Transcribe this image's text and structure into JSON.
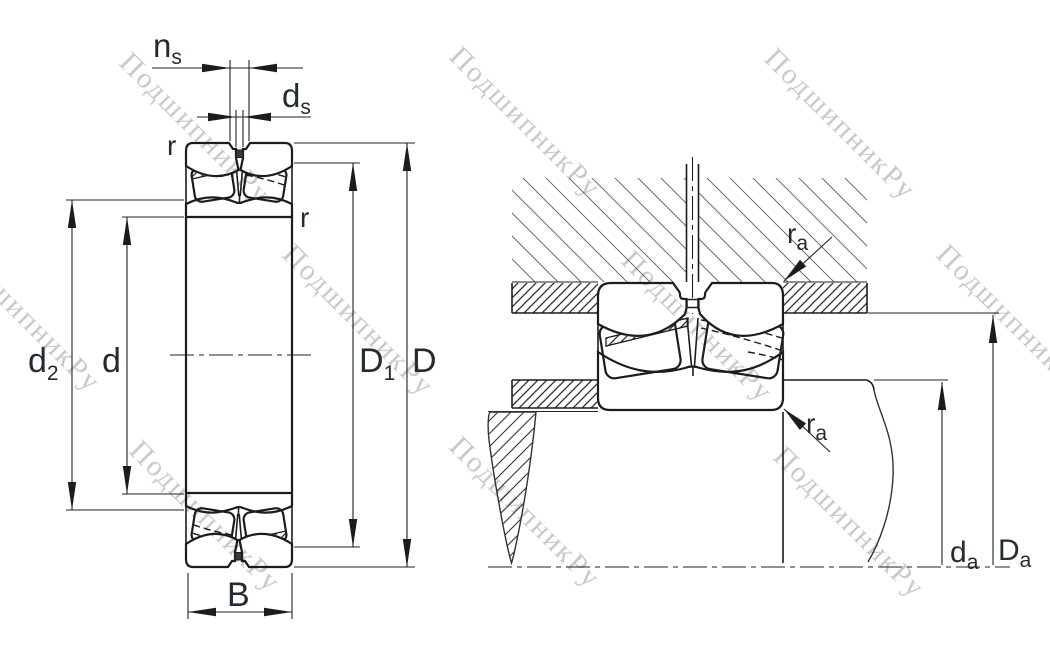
{
  "title": "spherical-roller-bearing-dimension-drawing",
  "watermark": {
    "text": "ПодшипникРу"
  },
  "colors": {
    "ink": "#1c1c1c",
    "label": "#232b33",
    "watermark": "#c9c9c9",
    "hatch_light": "#5f5f5f",
    "background": "#ffffff"
  },
  "labels": {
    "ns": {
      "main": "n",
      "sub": "s"
    },
    "ds": {
      "main": "d",
      "sub": "s"
    },
    "r_outer": {
      "main": "r",
      "sub": ""
    },
    "r_inner": {
      "main": "r",
      "sub": ""
    },
    "d2": {
      "main": "d",
      "sub": "2"
    },
    "d": {
      "main": "d",
      "sub": ""
    },
    "D1": {
      "main": "D",
      "sub": "1"
    },
    "D": {
      "main": "D",
      "sub": ""
    },
    "B": {
      "main": "B",
      "sub": ""
    },
    "ra_housing": {
      "main": "r",
      "sub": "a"
    },
    "ra_shaft": {
      "main": "r",
      "sub": "a"
    },
    "da": {
      "main": "d",
      "sub": "a"
    },
    "Da": {
      "main": "D",
      "sub": "a"
    }
  }
}
